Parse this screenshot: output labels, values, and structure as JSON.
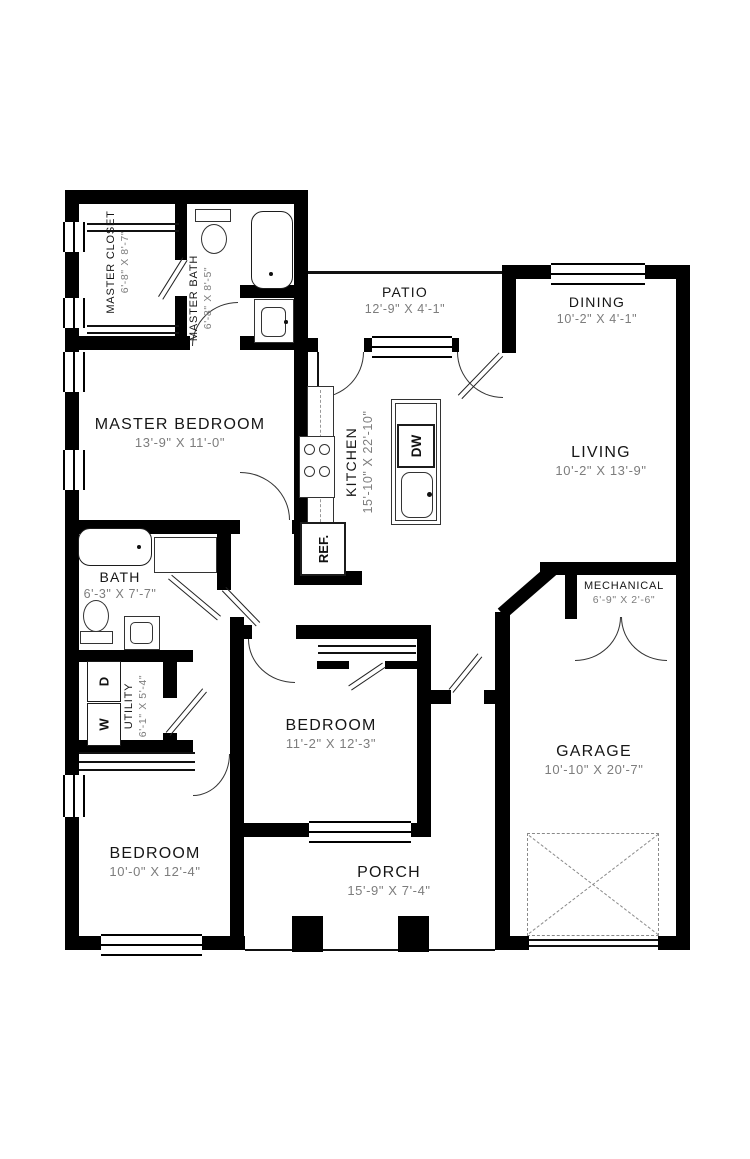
{
  "plan": {
    "type": "single-story house floor plan"
  },
  "rooms": [
    {
      "id": "master-closet",
      "name": "MASTER CLOSET",
      "dims": "6'-8\" X 8'-7\""
    },
    {
      "id": "master-bath",
      "name": "MASTER BATH",
      "dims": "6'-8\" X 8'-5\""
    },
    {
      "id": "patio",
      "name": "PATIO",
      "dims": "12'-9\" X 4'-1\""
    },
    {
      "id": "dining",
      "name": "DINING",
      "dims": "10'-2\" X 4'-1\""
    },
    {
      "id": "master-bedroom",
      "name": "MASTER BEDROOM",
      "dims": "13'-9\" X 11'-0\""
    },
    {
      "id": "kitchen",
      "name": "KITCHEN",
      "dims": "15'-10\" X 22'-10\""
    },
    {
      "id": "living",
      "name": "LIVING",
      "dims": "10'-2\" X 13'-9\""
    },
    {
      "id": "bath",
      "name": "BATH",
      "dims": "6'-3\" X 7'-7\""
    },
    {
      "id": "mechanical",
      "name": "MECHANICAL",
      "dims": "6'-9\" X 2'-6\""
    },
    {
      "id": "utility",
      "name": "UTILITY",
      "dims": "6'-1\" X 5'-4\""
    },
    {
      "id": "bedroom-2",
      "name": "BEDROOM",
      "dims": "11'-2\" X 12'-3\""
    },
    {
      "id": "garage",
      "name": "GARAGE",
      "dims": "10'-10\" X 20'-7\""
    },
    {
      "id": "bedroom-3",
      "name": "BEDROOM",
      "dims": "10'-0\" X 12'-4\""
    },
    {
      "id": "porch",
      "name": "PORCH",
      "dims": "15'-9\" X 7'-4\""
    }
  ],
  "appliances": {
    "refrigerator": "REF.",
    "dishwasher": "DW",
    "washer": "W",
    "dryer": "D"
  },
  "colors": {
    "wall": "#000000",
    "background": "#ffffff",
    "room_name": "#161616",
    "dimension_text": "#7d7d7d"
  }
}
